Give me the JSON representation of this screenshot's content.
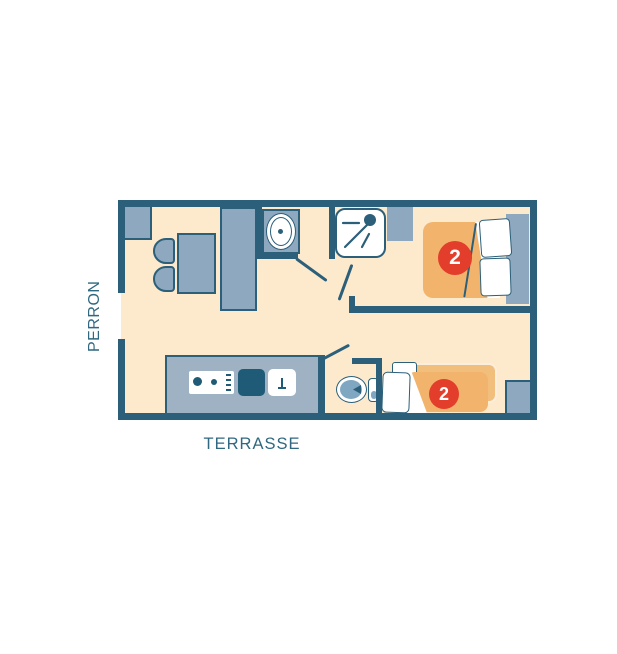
{
  "labels": {
    "perron": "PERRON",
    "terrasse": "TERRASSE"
  },
  "badges": {
    "double_bedroom_capacity": "2",
    "twin_bedroom_capacity": "2"
  },
  "colors": {
    "wall": "#2b5f7a",
    "floor": "#fde9cc",
    "furniture": "#8ea9bf",
    "counter": "#9fb2c4",
    "dark_fixture": "#1f5b76",
    "bed": "#f2b46c",
    "bed_light": "#f2be7c",
    "bed_light_edge": "#fbeedd",
    "red": "#e33d2b",
    "toilet_blue": "#7fa7c1",
    "text": "#2f6880"
  },
  "furniture_inventory": {
    "entrance_area": [
      "cabinet",
      "dining-table",
      "dining-chairs",
      "wardrobe"
    ],
    "bathroom": [
      "washbasin",
      "shower",
      "water-heater"
    ],
    "kitchen": [
      "counter",
      "stove",
      "sink"
    ],
    "wc": [
      "toilet"
    ],
    "double_bedroom": [
      "double-bed",
      "pillows",
      "headboard-shelf"
    ],
    "twin_bedroom": [
      "two-single-beds",
      "pillows",
      "nightstand"
    ]
  }
}
